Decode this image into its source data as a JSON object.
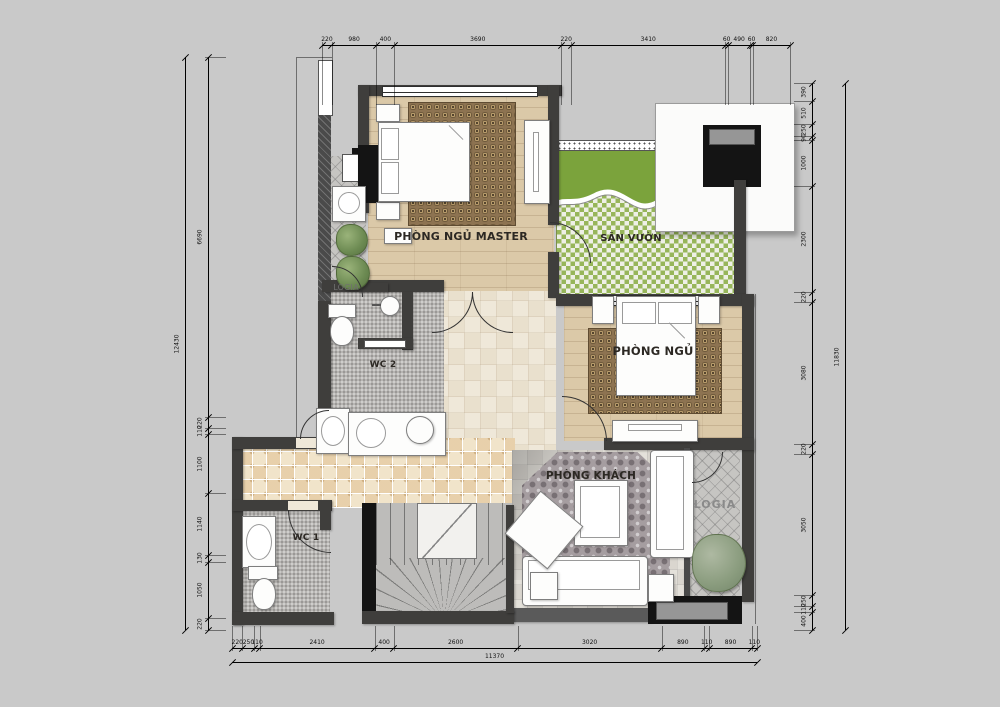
{
  "app": {
    "type": "architectural-floor-plan"
  },
  "rooms": {
    "master_bedroom": {
      "label": "PHÒNG NGỦ MASTER"
    },
    "garden": {
      "label": "SÂN VƯỜN"
    },
    "bedroom": {
      "label": "PHÒNG NGỦ"
    },
    "living_room": {
      "label": "PHÒNG KHÁCH"
    },
    "logia_left": {
      "label": "LOGIA"
    },
    "logia_right": {
      "label": "LOGIA"
    },
    "wc1": {
      "label": "WC 1"
    },
    "wc2": {
      "label": "WC 2"
    }
  },
  "colors": {
    "background": "#c9c9c9",
    "wall": "#3f3e3c",
    "wood_floor": "#dbc9a8",
    "rug": "#8d7351",
    "grass": "#7ba33c",
    "lattice_paver": "#97b65a",
    "encaustic_tile": "#f1e4ca",
    "mosaic_tile": "#b7b5b2",
    "damask_rug": "#a59da0"
  },
  "dimensions": {
    "top": {
      "values": [
        220,
        980,
        400,
        3690,
        220,
        3410,
        60,
        490,
        60,
        820
      ]
    },
    "bottom": {
      "values": [
        220,
        250,
        110,
        2410,
        400,
        2600,
        3020,
        890,
        110,
        890,
        110
      ]
    },
    "bottom_total": {
      "values": [
        11370
      ]
    },
    "left": {
      "values": [
        6690,
        220,
        110,
        1100,
        1140,
        130,
        1050,
        220
      ]
    },
    "left_total": {
      "values": [
        12430
      ]
    },
    "right": {
      "values": [
        390,
        510,
        250,
        90,
        1000,
        2300,
        220,
        3080,
        220,
        3050,
        250,
        110,
        400
      ]
    },
    "right_total": {
      "values": [
        11830
      ]
    }
  }
}
